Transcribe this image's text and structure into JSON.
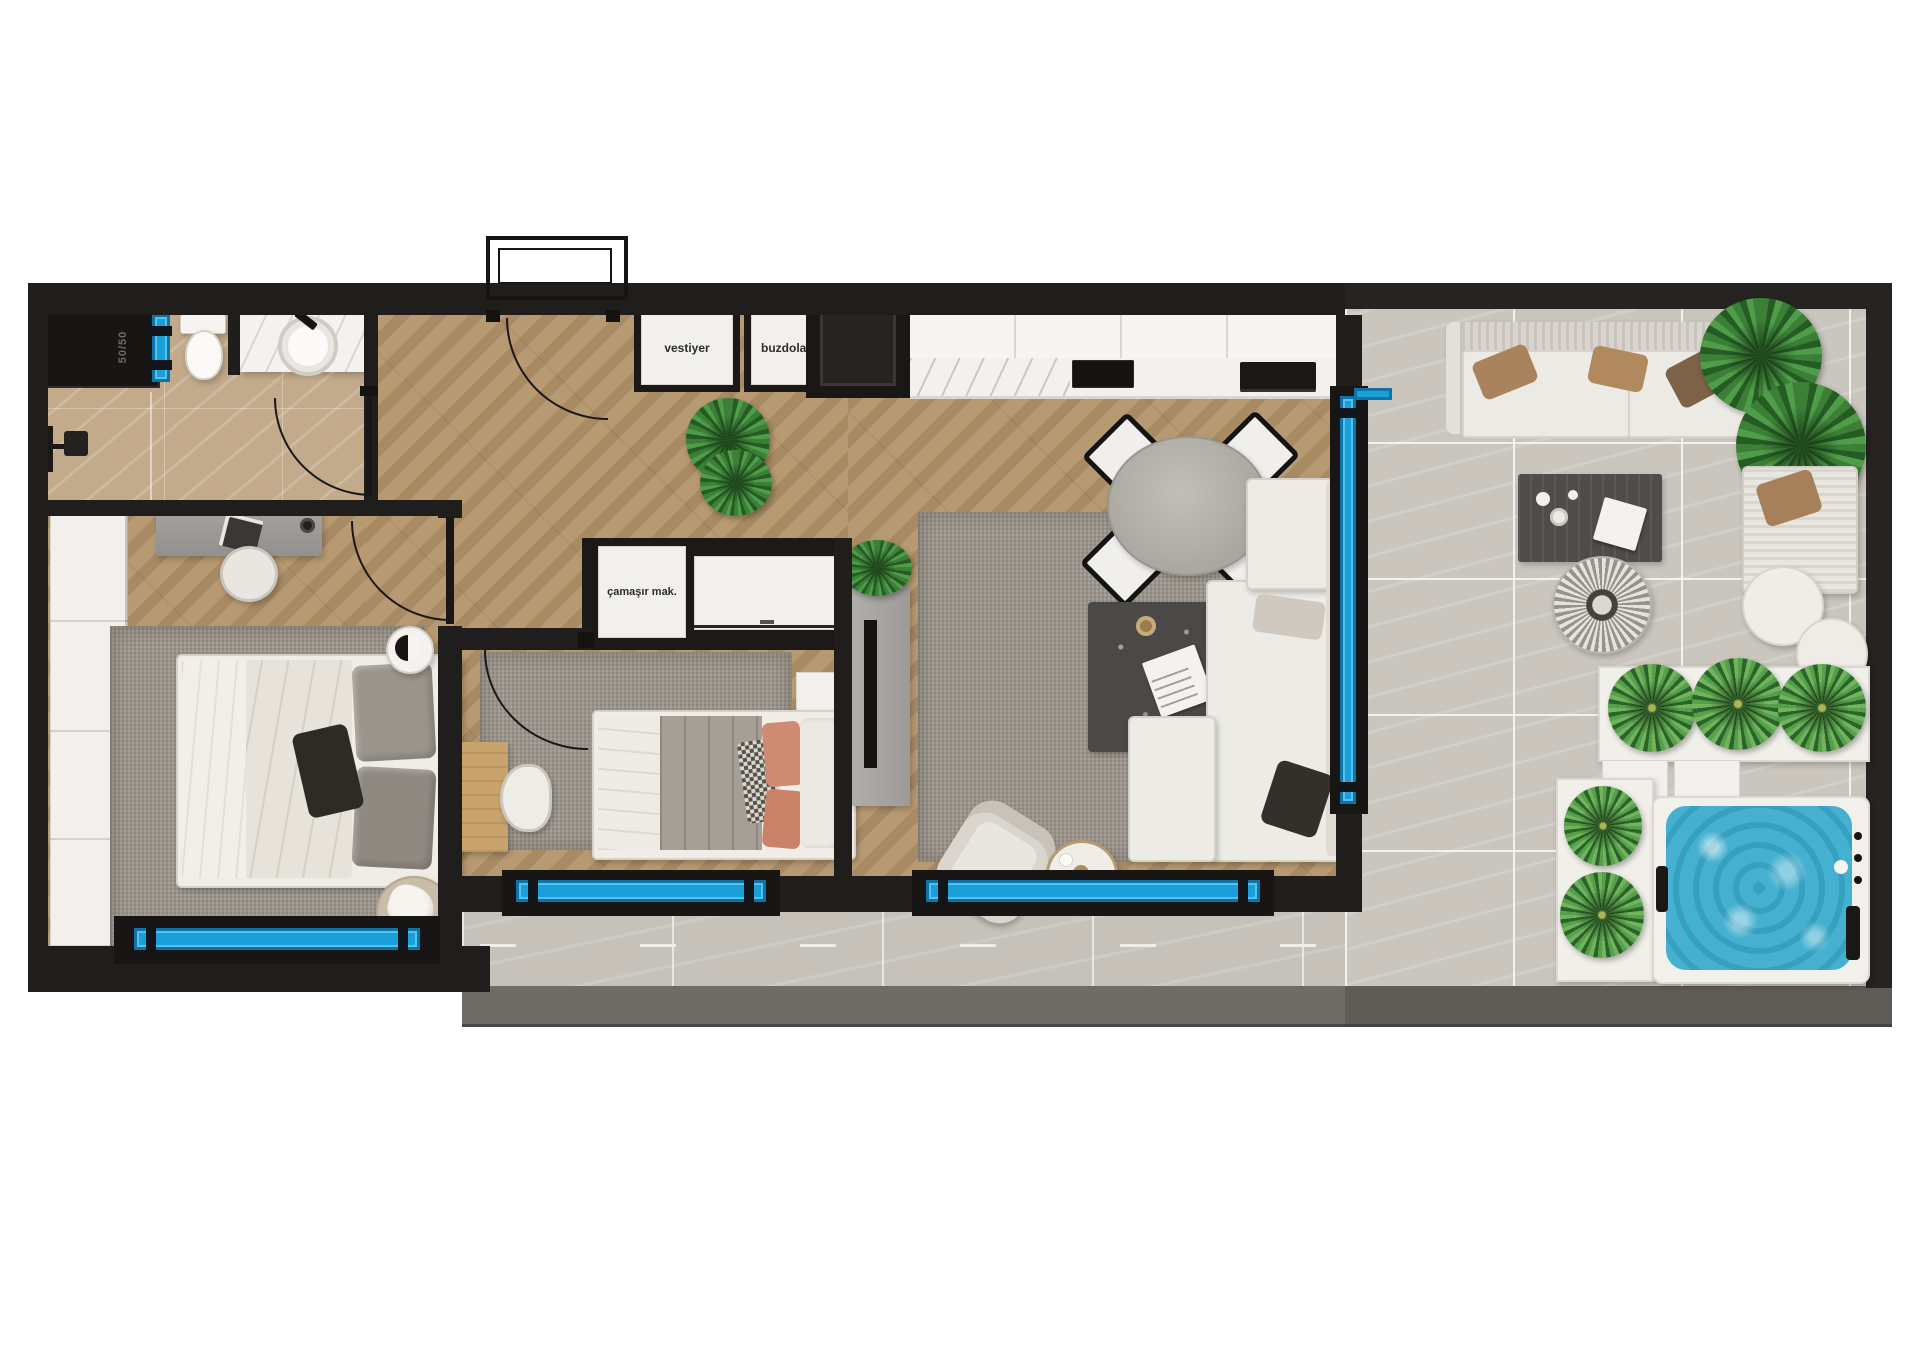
{
  "plan": {
    "labels": {
      "shaft_size": "50/50",
      "coat_closet": "vestiyer",
      "refrigerator": "buzdolabı",
      "washing_machine": "çamaşır mak."
    },
    "colors": {
      "background": "#ffffff",
      "wall": "#201e1c",
      "window_accent": "#1b9fd9",
      "wood_floor": "#b4966e",
      "bathroom_floor": "#c2aa8b",
      "terrace_floor": "#cac6be",
      "walkway_band": "#6f6b66",
      "rug": "#9b958b",
      "jacuzzi_water": "#45b0d0",
      "plant_green": "#3c8038"
    }
  }
}
